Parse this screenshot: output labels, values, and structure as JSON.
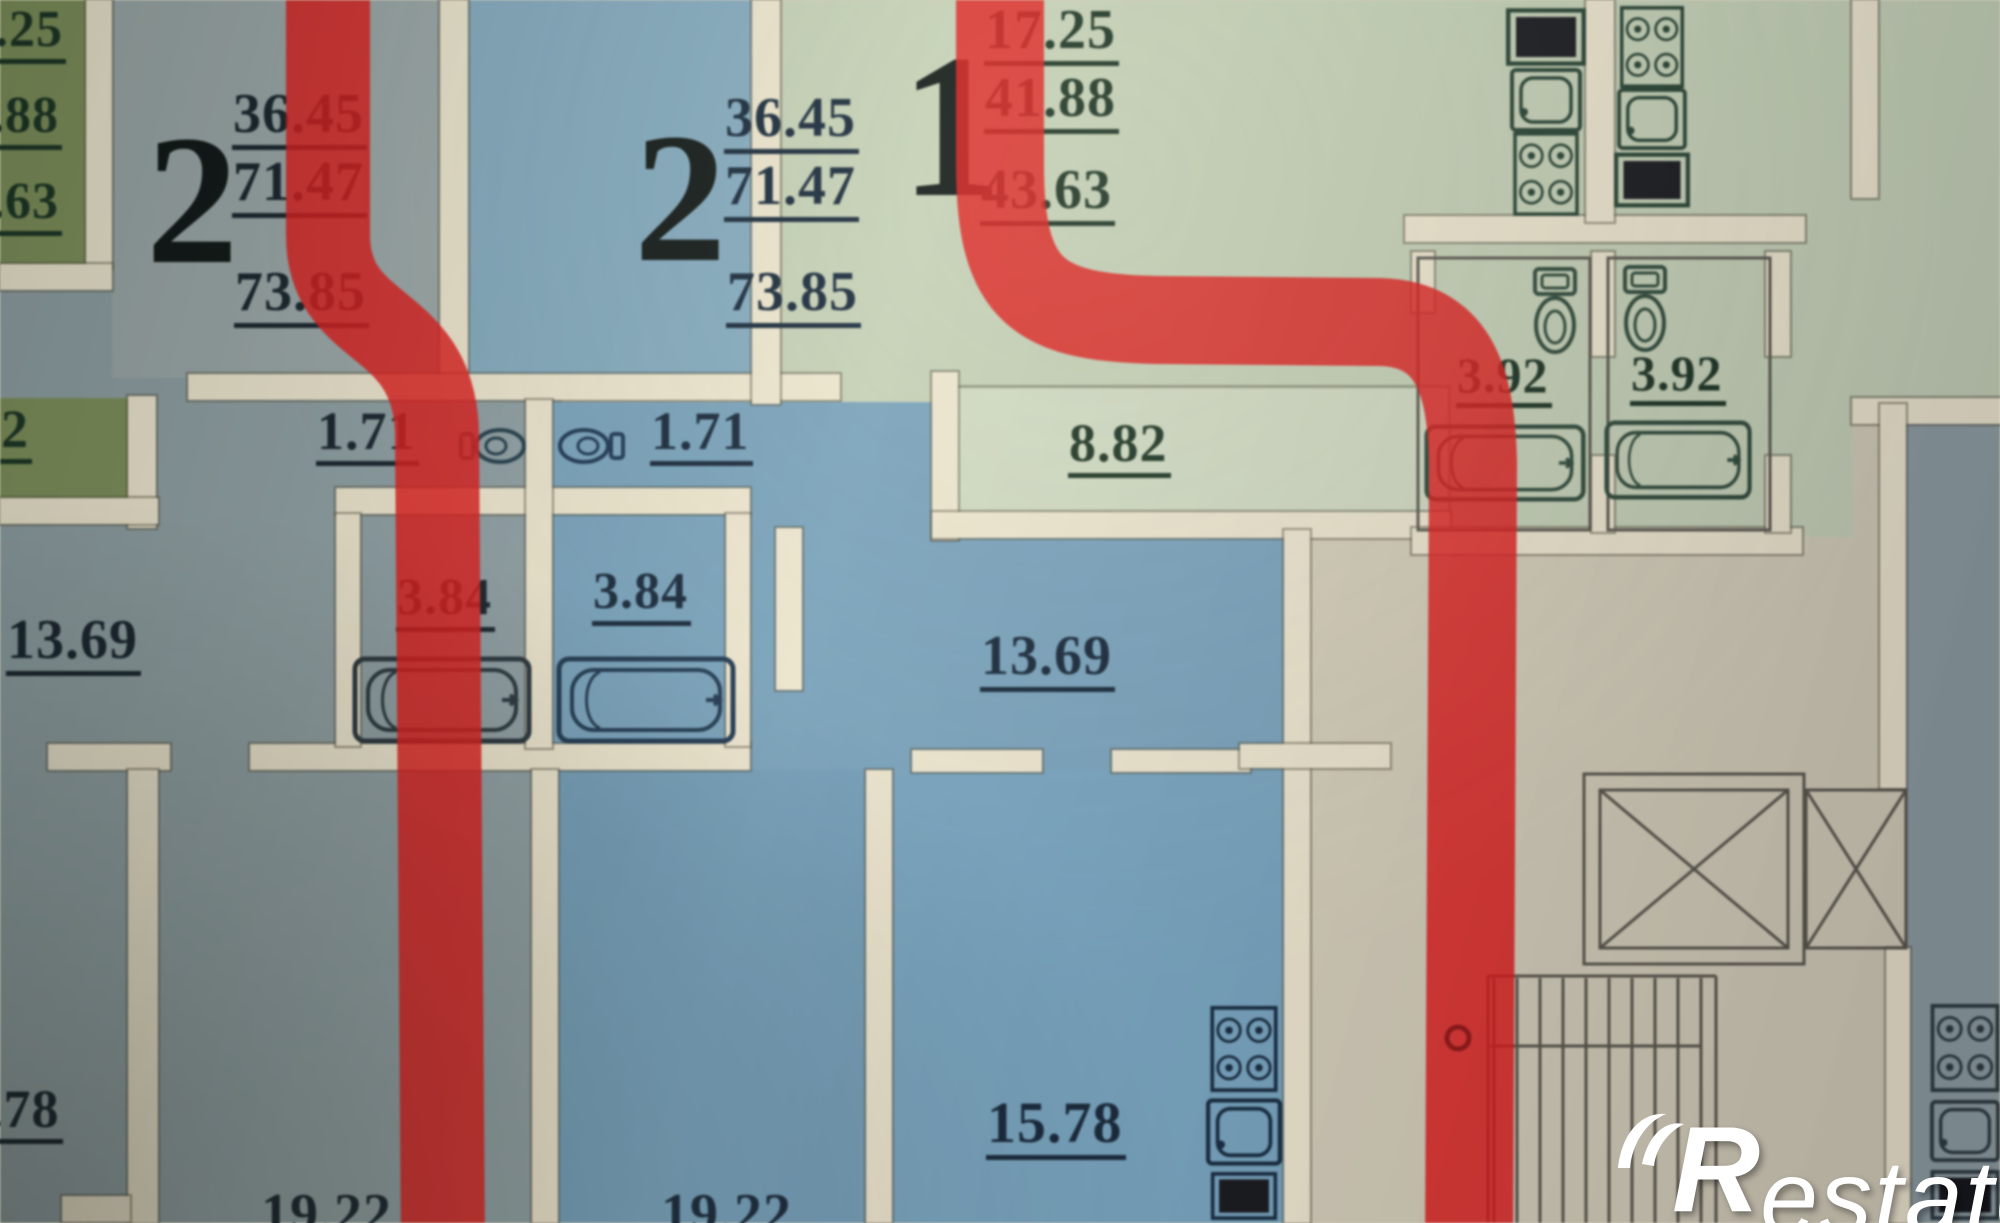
{
  "plan_title": "apartment floor plan photo",
  "watermark": {
    "brand": "Restate",
    "brand_r": "R",
    "brand_rest": "estate"
  },
  "colors": {
    "red_route": "#e61414",
    "red_route_dark": "#8f0f0f",
    "wall": "#ece4cc",
    "apartment_olive": "#7b8d55",
    "apartment_gray_blue": "#8c9da2",
    "apartment_blue": "#7fa8c0",
    "apartment_sage": "#c3cfb4",
    "corridor": "#d3ccb8"
  },
  "apartments": {
    "left_edge": {
      "areas": [
        ".25",
        ".88",
        ".63"
      ],
      "room_partial": "2",
      "room_13_69": "13.69",
      "room_78": ".78"
    },
    "apt_a": {
      "unit": "2",
      "area_living": "36.45",
      "area_total": "71.47",
      "area_overall": "73.85",
      "wc": "1.71",
      "bathroom": "3.84",
      "room_19_22": "19.22"
    },
    "apt_b": {
      "unit": "2",
      "area_living": "36.45",
      "area_total": "71.47",
      "area_overall": "73.85",
      "wc": "1.71",
      "bathroom": "3.84",
      "room_13_69": "13.69",
      "kitchen_15_78": "15.78",
      "room_19_22": "19.22"
    },
    "apt_c": {
      "unit": "1",
      "area_living": "17.25",
      "area_total": "41.88",
      "area_overall": "43.63",
      "hall": "8.82",
      "bathroom_a": "3.92",
      "bathroom_b": "3.92"
    }
  },
  "icons": {
    "toilet-top-icon": "svg-shape",
    "toilet-side-icon": "svg-shape",
    "bathtub-icon": "svg-shape",
    "stove-icon": "svg-shape",
    "sink-icon": "svg-shape",
    "counter-icon": "svg-shape",
    "elevator-x-icon": "svg-shape",
    "stairs-icon": "svg-shape",
    "route-line": "red-stripe",
    "brand-swoosh-icon": "svg-shape"
  }
}
